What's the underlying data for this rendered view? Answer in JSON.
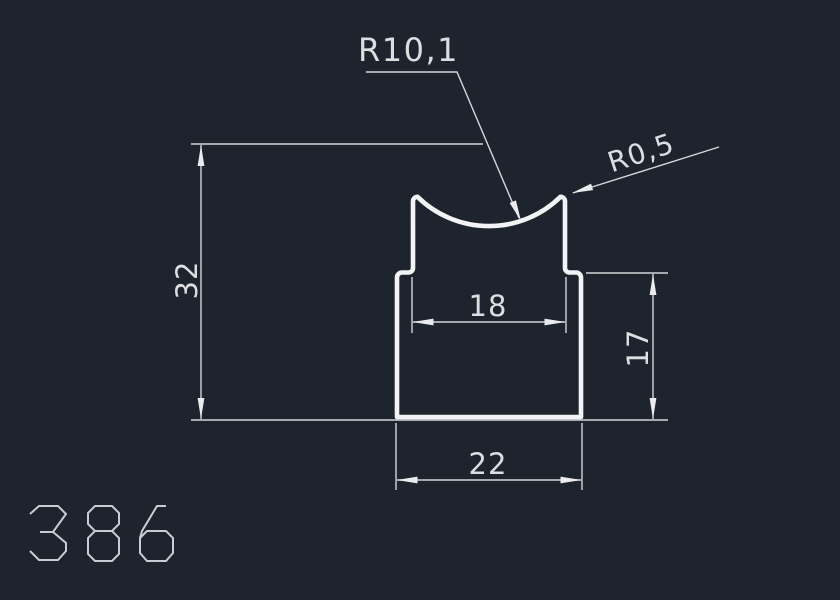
{
  "canvas": {
    "background": "#1e242e",
    "geometry_color": "#f2f3f5",
    "dimension_color": "#d3d6da"
  },
  "part": {
    "number": "386"
  },
  "dimensions": {
    "total_height": "32",
    "top_width": "18",
    "base_height": "17",
    "base_width": "22",
    "groove_radius": "R10,1",
    "corner_radius": "R0,5"
  }
}
